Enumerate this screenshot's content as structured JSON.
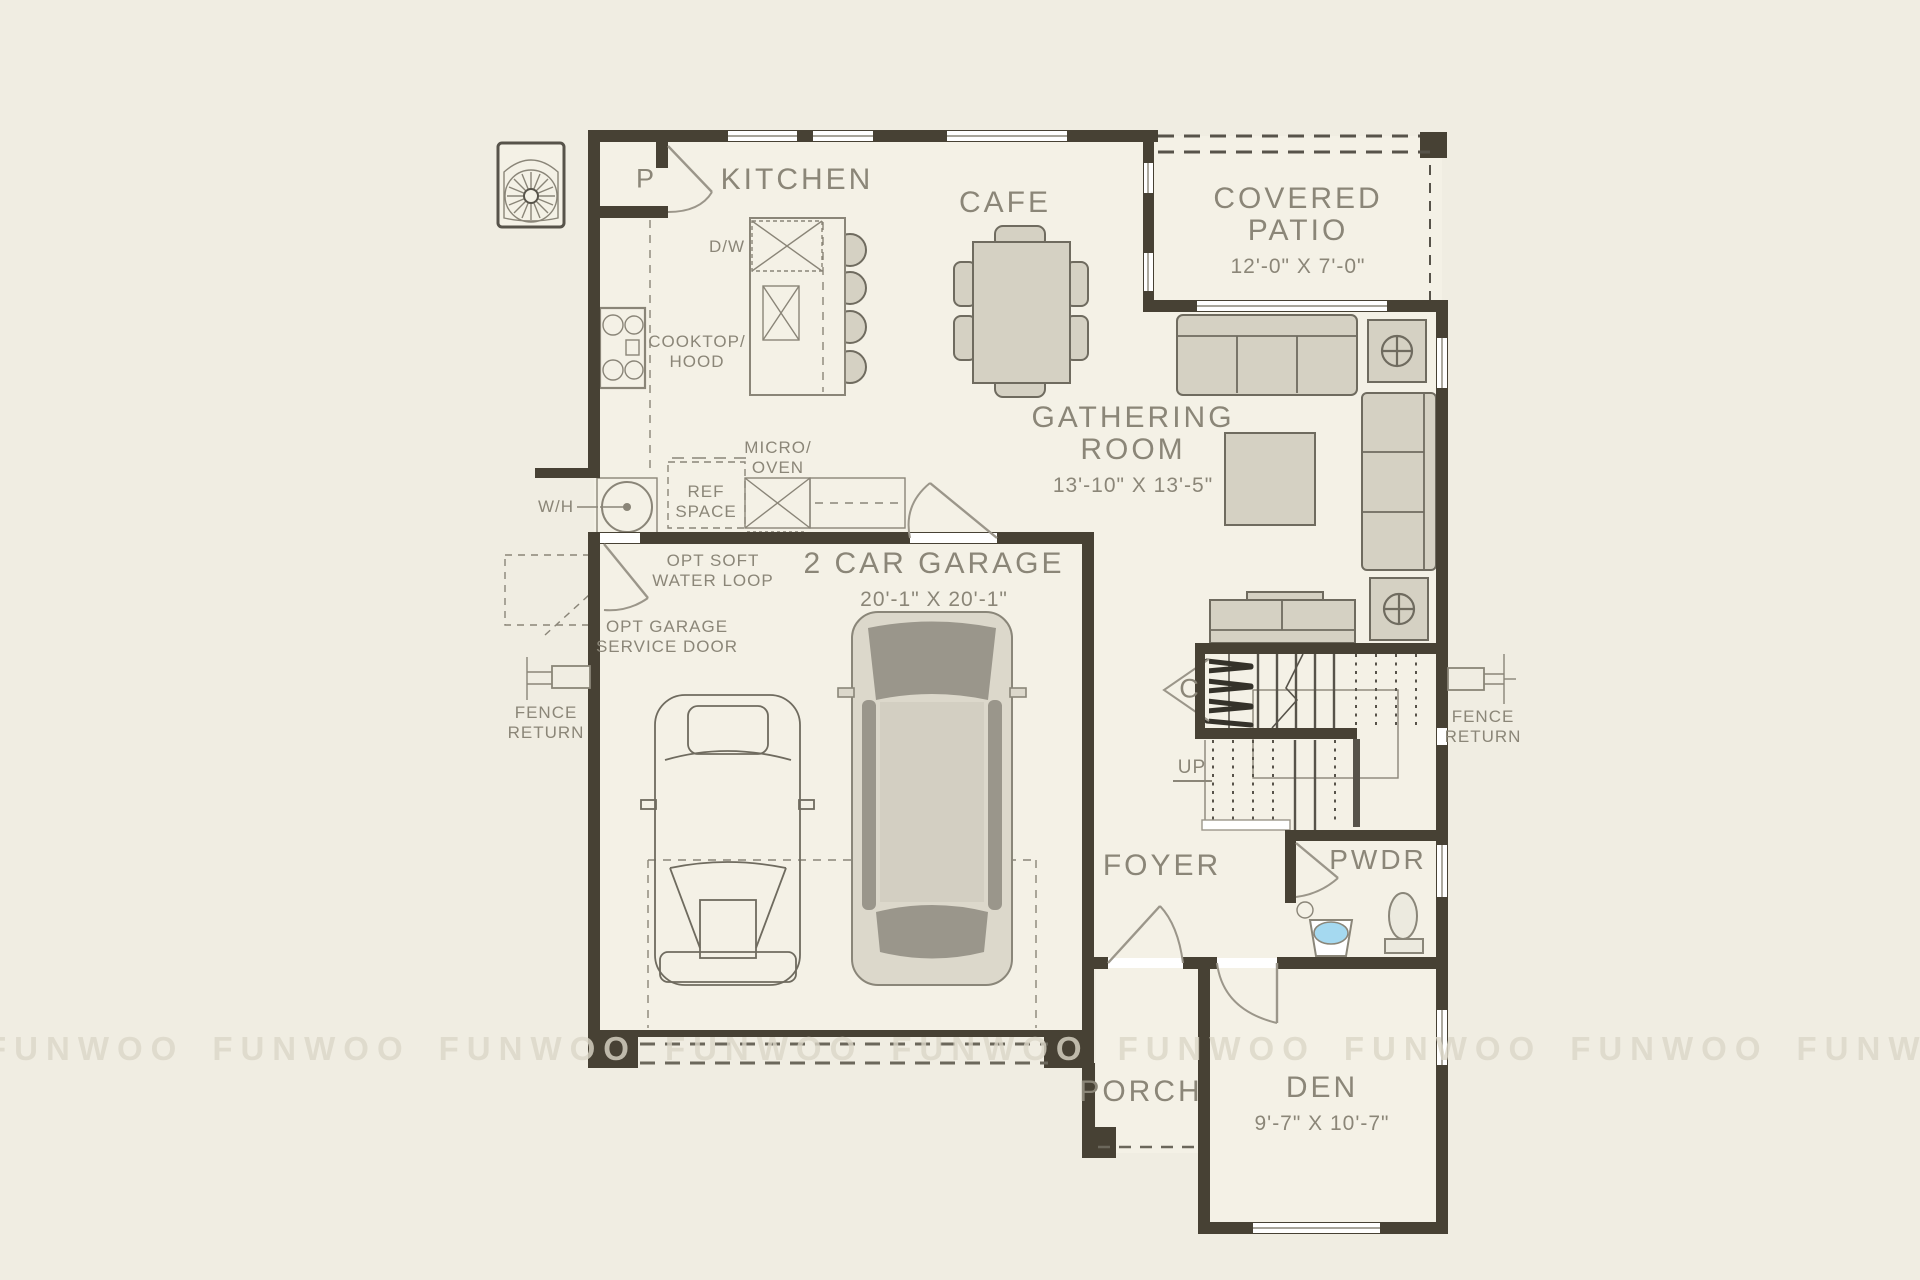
{
  "colors": {
    "bg": "#f0ede2",
    "floor": "#f4f1e6",
    "wall": "#474134",
    "line": "#8a8578",
    "furn": "#d5d1c3",
    "furnstroke": "#6f6b5f",
    "text": "#8b8678",
    "sink": "#a5d9f0",
    "wm": "#dcd7c8"
  },
  "watermark": {
    "text": "FUNWOO",
    "count": 9
  },
  "rooms": {
    "kitchen": {
      "name": "KITCHEN"
    },
    "cafe": {
      "name": "CAFE"
    },
    "covered_patio": {
      "name_line1": "COVERED",
      "name_line2": "PATIO",
      "dims": "12'-0\" X 7'-0\""
    },
    "gathering_room": {
      "name_line1": "GATHERING",
      "name_line2": "ROOM",
      "dims": "13'-10\" X 13'-5\""
    },
    "garage": {
      "name": "2 CAR GARAGE",
      "dims": "20'-1\" X 20'-1\""
    },
    "foyer": {
      "name": "FOYER"
    },
    "powder_room": {
      "name": "PWDR"
    },
    "porch": {
      "name": "PORCH"
    },
    "den": {
      "name": "DEN",
      "dims": "9'-7\" X 10'-7\""
    }
  },
  "labels": {
    "pantry": "P",
    "closet": "C",
    "dishwasher": "D/W",
    "cooktop_line1": "COOKTOP/",
    "cooktop_line2": "HOOD",
    "micro_line1": "MICRO/",
    "micro_line2": "OVEN",
    "ref_line1": "REF",
    "ref_line2": "SPACE",
    "water_heater": "W/H",
    "opt_soft_line1": "OPT SOFT",
    "opt_soft_line2": "WATER LOOP",
    "opt_garage_line1": "OPT GARAGE",
    "opt_garage_line2": "SERVICE DOOR",
    "fence_line1": "FENCE",
    "fence_line2": "RETURN",
    "up": "UP"
  }
}
